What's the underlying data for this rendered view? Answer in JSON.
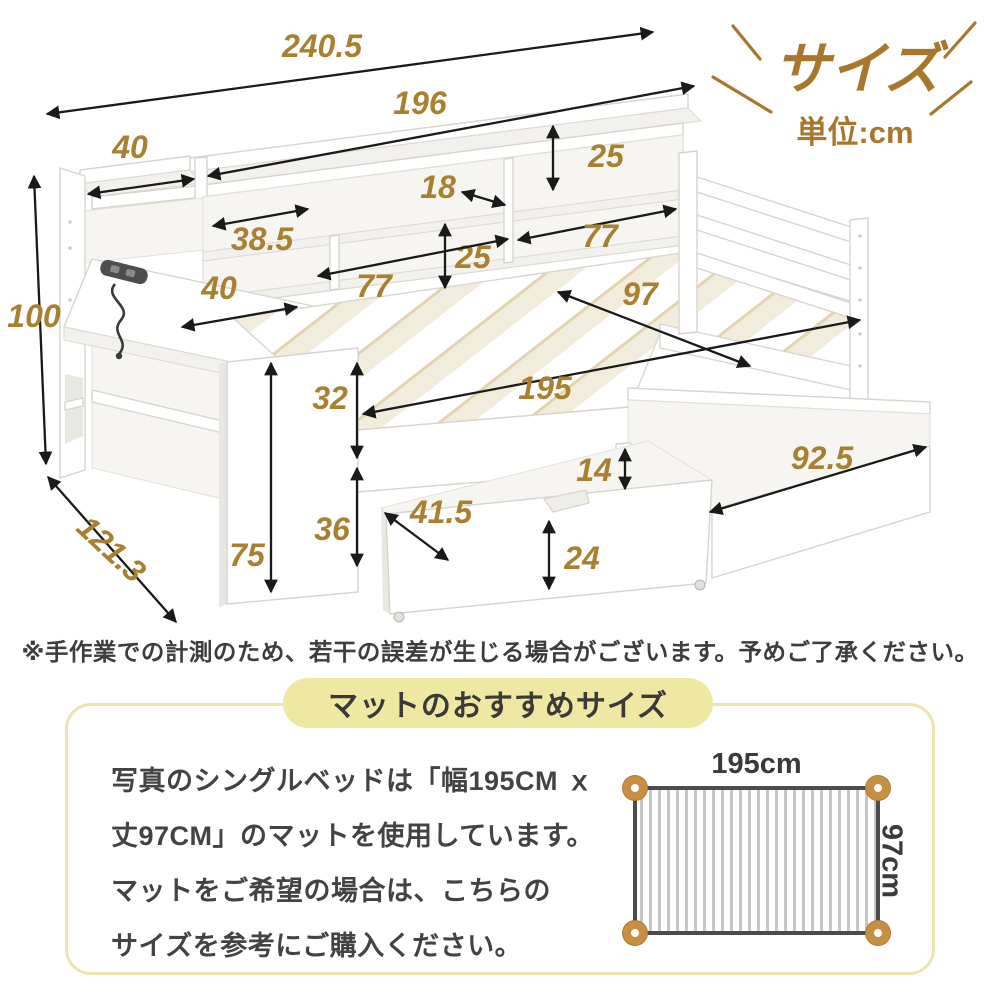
{
  "header": {
    "title": "サイズ",
    "unit_label": "単位:cm"
  },
  "dimensions": [
    {
      "label": "240.5",
      "fs": 36,
      "lx": 322,
      "ly": 57,
      "x1": 47,
      "y1": 114,
      "x2": 653,
      "y2": 32
    },
    {
      "label": "196",
      "fs": 36,
      "lx": 420,
      "ly": 114,
      "x1": 208,
      "y1": 176,
      "x2": 694,
      "y2": 86
    },
    {
      "label": "40",
      "lx": 130,
      "ly": 158,
      "x1": 88,
      "y1": 194,
      "x2": 194,
      "y2": 179
    },
    {
      "label": "25",
      "lx": 606,
      "ly": 167,
      "x1": 553,
      "y1": 126,
      "x2": 553,
      "y2": 190
    },
    {
      "label": "18",
      "lx": 438,
      "ly": 198,
      "x1": 462,
      "y1": 192,
      "x2": 505,
      "y2": 205
    },
    {
      "label": "38.5",
      "lx": 262,
      "ly": 250,
      "x1": 213,
      "y1": 226,
      "x2": 308,
      "y2": 209
    },
    {
      "label": "25",
      "lx": 473,
      "ly": 268,
      "x1": 445,
      "y1": 224,
      "x2": 445,
      "y2": 288
    },
    {
      "label": "77",
      "lx": 374,
      "ly": 297,
      "x1": 318,
      "y1": 276,
      "x2": 508,
      "y2": 239
    },
    {
      "label": "77",
      "lx": 600,
      "ly": 247,
      "x1": 518,
      "y1": 240,
      "x2": 676,
      "y2": 209
    },
    {
      "label": "100",
      "fs": 36,
      "lx": 34,
      "ly": 327,
      "x1": 34,
      "y1": 176,
      "x2": 46,
      "y2": 464
    },
    {
      "label": "40",
      "lx": 219,
      "ly": 299,
      "x1": 182,
      "y1": 327,
      "x2": 297,
      "y2": 307
    },
    {
      "label": "97",
      "fs": 36,
      "lx": 640,
      "ly": 305,
      "x1": 558,
      "y1": 292,
      "x2": 750,
      "y2": 366
    },
    {
      "label": "195",
      "fs": 36,
      "lx": 545,
      "ly": 399,
      "x1": 363,
      "y1": 414,
      "x2": 860,
      "y2": 320
    },
    {
      "label": "32",
      "lx": 330,
      "ly": 409,
      "x1": 357,
      "y1": 363,
      "x2": 357,
      "y2": 458
    },
    {
      "label": "75",
      "lx": 247,
      "ly": 566,
      "x1": 271,
      "y1": 363,
      "x2": 271,
      "y2": 592
    },
    {
      "label": "36",
      "lx": 332,
      "ly": 540,
      "x1": 357,
      "y1": 468,
      "x2": 357,
      "y2": 566
    },
    {
      "label": "121.3",
      "fs": 36,
      "lx": 104,
      "ly": 557,
      "rotate": 43,
      "x1": 48,
      "y1": 477,
      "x2": 176,
      "y2": 622
    },
    {
      "label": "14",
      "lx": 594,
      "ly": 481,
      "x1": 625,
      "y1": 449,
      "x2": 625,
      "y2": 489
    },
    {
      "label": "41.5",
      "lx": 441,
      "ly": 523,
      "x1": 385,
      "y1": 513,
      "x2": 448,
      "y2": 560
    },
    {
      "label": "24",
      "lx": 582,
      "ly": 569,
      "x1": 549,
      "y1": 521,
      "x2": 549,
      "y2": 589
    },
    {
      "label": "92.5",
      "fs": 36,
      "lx": 822,
      "ly": 469,
      "x1": 710,
      "y1": 512,
      "x2": 926,
      "y2": 447
    }
  ],
  "disclaimer": "※手作業での計測のため、若干の誤差が生じる場合がございます。予めご了承ください。",
  "mat_section": {
    "title": "マットのおすすめサイズ",
    "body_lines": [
      "写真のシングルベッドは「幅195CM ｘ",
      "丈97CM」のマットを使用しています。",
      "マットをご希望の場合は、こちらの",
      "サイズを参考にご購入ください。"
    ],
    "mat_width": "195cm",
    "mat_height": "97cm"
  },
  "colors": {
    "accent_brown": "#a8772b",
    "dim_text": "#a9802f",
    "arrow": "#1a1a1a",
    "pill_bg": "#eee8a3",
    "box_border": "#ebe4ad",
    "mat_border": "#4b4b4b",
    "mat_corner": "#c68f41",
    "text_dark": "#3d3d3d",
    "slat_cream": "#f2ecdd"
  }
}
